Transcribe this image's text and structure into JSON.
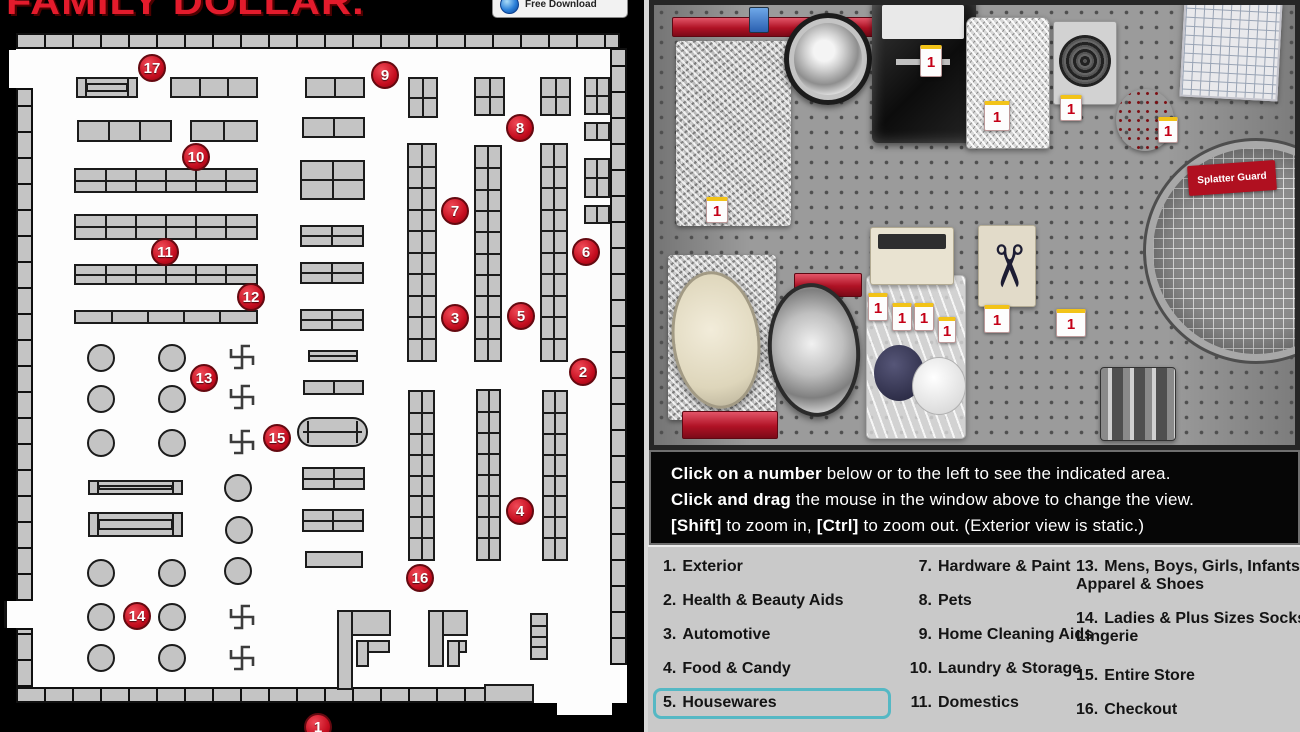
{
  "colors": {
    "marker_red": "#c50d1f",
    "highlight_teal": "#55b8c4",
    "legend_bg": "#c9c9c9",
    "logo_red": "#e31b2c"
  },
  "branding": {
    "logo": "FAMILY DOLLAR.",
    "badge": "Free Download"
  },
  "instructions": {
    "lines": [
      [
        {
          "text": "Click on a number",
          "bold": true
        },
        {
          "text": " below or to the left to see the indicated area.",
          "bold": false
        }
      ],
      [
        {
          "text": "Click and drag",
          "bold": true
        },
        {
          "text": " the mouse in the window above to change the view.",
          "bold": false
        }
      ],
      [
        {
          "text": "[Shift]",
          "bold": true
        },
        {
          "text": " to zoom in, ",
          "bold": false
        },
        {
          "text": "[Ctrl]",
          "bold": true
        },
        {
          "text": " to zoom out. (Exterior view is static.)",
          "bold": false
        }
      ]
    ]
  },
  "legend": {
    "selected_number": "5",
    "columns": [
      {
        "x": 15,
        "width": 215,
        "cls": "col1",
        "items": [
          {
            "num": "1.",
            "label": "Exterior",
            "y": 11
          },
          {
            "num": "2.",
            "label": "Health & Beauty Aids",
            "y": 45
          },
          {
            "num": "3.",
            "label": "Automotive",
            "y": 79
          },
          {
            "num": "4.",
            "label": "Food & Candy",
            "y": 113
          },
          {
            "num": "5.",
            "label": "Housewares",
            "y": 147,
            "selected": true
          }
        ]
      },
      {
        "x": 258,
        "width": 215,
        "cls": "col2",
        "items": [
          {
            "num": "7.",
            "label": "Hardware & Paint",
            "y": 11
          },
          {
            "num": "8.",
            "label": "Pets",
            "y": 45
          },
          {
            "num": "9.",
            "label": "Home Cleaning Aids",
            "y": 79
          },
          {
            "num": "10.",
            "label": "Laundry & Storage",
            "y": 113
          },
          {
            "num": "11.",
            "label": "Domestics",
            "y": 147
          }
        ]
      },
      {
        "x": 428,
        "width": 235,
        "cls": "col3",
        "items": [
          {
            "num": "13.",
            "label": "Mens, Boys, Girls, Infants Apparel & Shoes",
            "y": 11
          },
          {
            "num": "14.",
            "label": "Ladies & Plus Sizes Socks, Lingerie",
            "y": 63
          },
          {
            "num": "15.",
            "label": "Entire Store",
            "y": 120
          },
          {
            "num": "16.",
            "label": "Checkout",
            "y": 154
          }
        ]
      }
    ]
  },
  "map": {
    "floor": {
      "x": 16,
      "y": 48,
      "w": 611,
      "h": 655
    },
    "walls": [
      {
        "x": 16,
        "y": 33,
        "w": 604,
        "h": 16,
        "d": "h"
      },
      {
        "x": 16,
        "y": 687,
        "w": 472,
        "h": 16,
        "d": "h"
      },
      {
        "x": 16,
        "y": 88,
        "w": 17,
        "h": 513,
        "d": "v"
      },
      {
        "x": 16,
        "y": 628,
        "w": 17,
        "h": 59,
        "d": "v"
      },
      {
        "x": 610,
        "y": 48,
        "w": 17,
        "h": 617,
        "d": "v"
      }
    ],
    "notches": [
      {
        "x": 9,
        "y": 50,
        "w": 24,
        "h": 38,
        "edge": false
      },
      {
        "x": 4,
        "y": 601,
        "w": 14,
        "h": 27,
        "edge": true
      },
      {
        "x": 557,
        "y": 700,
        "w": 55,
        "h": 15,
        "edge": false
      }
    ],
    "shelves": [
      {
        "x": 76,
        "y": 77,
        "w": 62,
        "h": 21,
        "t": "rack"
      },
      {
        "x": 170,
        "y": 77,
        "w": 88,
        "h": 21,
        "c": 3
      },
      {
        "x": 305,
        "y": 77,
        "w": 60,
        "h": 21,
        "c": 2
      },
      {
        "x": 408,
        "y": 77,
        "w": 30,
        "h": 41,
        "c": 2,
        "r": 2
      },
      {
        "x": 474,
        "y": 77,
        "w": 31,
        "h": 39,
        "c": 2,
        "r": 2
      },
      {
        "x": 540,
        "y": 77,
        "w": 31,
        "h": 39,
        "c": 2,
        "r": 2
      },
      {
        "x": 584,
        "y": 77,
        "w": 26,
        "h": 38,
        "c": 2,
        "r": 2
      },
      {
        "x": 584,
        "y": 122,
        "w": 26,
        "h": 19,
        "c": 2
      },
      {
        "x": 584,
        "y": 158,
        "w": 26,
        "h": 40,
        "c": 2,
        "r": 2
      },
      {
        "x": 584,
        "y": 205,
        "w": 26,
        "h": 19,
        "c": 2
      },
      {
        "x": 77,
        "y": 120,
        "w": 95,
        "h": 22,
        "c": 3
      },
      {
        "x": 190,
        "y": 120,
        "w": 68,
        "h": 22,
        "c": 2
      },
      {
        "x": 302,
        "y": 117,
        "w": 63,
        "h": 21,
        "c": 2
      },
      {
        "x": 74,
        "y": 168,
        "w": 184,
        "h": 25,
        "c": 6,
        "r": 2
      },
      {
        "x": 74,
        "y": 214,
        "w": 184,
        "h": 26,
        "c": 6,
        "r": 2
      },
      {
        "x": 74,
        "y": 264,
        "w": 184,
        "h": 21,
        "c": 6,
        "r": 2
      },
      {
        "x": 74,
        "y": 310,
        "w": 184,
        "h": 14,
        "c": 5
      },
      {
        "x": 300,
        "y": 160,
        "w": 65,
        "h": 40,
        "c": 2,
        "r": 2
      },
      {
        "x": 300,
        "y": 225,
        "w": 64,
        "h": 22,
        "c": 2,
        "r": 2
      },
      {
        "x": 300,
        "y": 262,
        "w": 64,
        "h": 22,
        "c": 2,
        "r": 2
      },
      {
        "x": 300,
        "y": 309,
        "w": 64,
        "h": 22,
        "c": 2,
        "r": 2
      },
      {
        "x": 308,
        "y": 350,
        "w": 50,
        "h": 12,
        "r": 2
      },
      {
        "x": 303,
        "y": 380,
        "w": 61,
        "h": 15,
        "c": 2
      },
      {
        "x": 297,
        "y": 417,
        "w": 71,
        "h": 30,
        "t": "capsule"
      },
      {
        "x": 302,
        "y": 467,
        "w": 63,
        "h": 23,
        "c": 2,
        "r": 2
      },
      {
        "x": 302,
        "y": 509,
        "w": 62,
        "h": 23,
        "c": 2,
        "r": 2
      },
      {
        "x": 305,
        "y": 551,
        "w": 58,
        "h": 17
      },
      {
        "x": 407,
        "y": 143,
        "w": 30,
        "h": 219,
        "c": 2,
        "r": 10
      },
      {
        "x": 474,
        "y": 145,
        "w": 28,
        "h": 217,
        "c": 2,
        "r": 10
      },
      {
        "x": 540,
        "y": 143,
        "w": 28,
        "h": 219,
        "c": 2,
        "r": 10
      },
      {
        "x": 408,
        "y": 390,
        "w": 27,
        "h": 171,
        "c": 2,
        "r": 8
      },
      {
        "x": 476,
        "y": 389,
        "w": 25,
        "h": 172,
        "c": 2,
        "r": 8
      },
      {
        "x": 542,
        "y": 390,
        "w": 26,
        "h": 171,
        "c": 2,
        "r": 8
      },
      {
        "x": 88,
        "y": 480,
        "w": 95,
        "h": 15,
        "t": "rack"
      },
      {
        "x": 88,
        "y": 512,
        "w": 95,
        "h": 25,
        "t": "rack"
      },
      {
        "x": 337,
        "y": 610,
        "w": 54,
        "h": 26
      },
      {
        "x": 337,
        "y": 610,
        "w": 16,
        "h": 80
      },
      {
        "x": 356,
        "y": 640,
        "w": 34,
        "h": 13
      },
      {
        "x": 356,
        "y": 640,
        "w": 13,
        "h": 27
      },
      {
        "x": 428,
        "y": 610,
        "w": 40,
        "h": 26
      },
      {
        "x": 428,
        "y": 610,
        "w": 16,
        "h": 57
      },
      {
        "x": 447,
        "y": 640,
        "w": 20,
        "h": 13
      },
      {
        "x": 447,
        "y": 640,
        "w": 13,
        "h": 27
      },
      {
        "x": 530,
        "y": 613,
        "w": 18,
        "h": 47,
        "r": 4
      },
      {
        "x": 484,
        "y": 684,
        "w": 50,
        "h": 19
      }
    ],
    "circle_racks": [
      [
        101,
        358
      ],
      [
        172,
        358
      ],
      [
        101,
        399
      ],
      [
        172,
        399
      ],
      [
        101,
        443
      ],
      [
        172,
        443
      ],
      [
        101,
        573
      ],
      [
        172,
        573
      ],
      [
        101,
        617
      ],
      [
        172,
        617
      ],
      [
        101,
        658
      ],
      [
        172,
        658
      ],
      [
        238,
        488
      ],
      [
        239,
        530
      ],
      [
        238,
        571
      ]
    ],
    "pinwheel_racks": [
      [
        242,
        357
      ],
      [
        242,
        397
      ],
      [
        242,
        442
      ],
      [
        242,
        617
      ],
      [
        242,
        658
      ]
    ],
    "markers": [
      {
        "n": "1",
        "x": 318,
        "y": 727
      },
      {
        "n": "2",
        "x": 583,
        "y": 372
      },
      {
        "n": "3",
        "x": 455,
        "y": 318
      },
      {
        "n": "4",
        "x": 520,
        "y": 511
      },
      {
        "n": "5",
        "x": 521,
        "y": 316
      },
      {
        "n": "6",
        "x": 586,
        "y": 252
      },
      {
        "n": "7",
        "x": 455,
        "y": 211
      },
      {
        "n": "8",
        "x": 520,
        "y": 128
      },
      {
        "n": "9",
        "x": 385,
        "y": 75
      },
      {
        "n": "10",
        "x": 196,
        "y": 157
      },
      {
        "n": "11",
        "x": 165,
        "y": 252
      },
      {
        "n": "12",
        "x": 251,
        "y": 297
      },
      {
        "n": "13",
        "x": 204,
        "y": 378
      },
      {
        "n": "14",
        "x": 137,
        "y": 616
      },
      {
        "n": "15",
        "x": 277,
        "y": 438
      },
      {
        "n": "16",
        "x": 420,
        "y": 578
      },
      {
        "n": "17",
        "x": 152,
        "y": 68
      }
    ]
  },
  "photo": {
    "price_tag": "1",
    "splatter_label": "Splatter Guard",
    "scissors_glyph": "✂",
    "products": [
      {
        "kind": "rail",
        "name": "red-shelf-rail",
        "x": 18,
        "y": 12,
        "w": 250,
        "h": 20
      },
      {
        "kind": "tagblue",
        "name": "hanging-tag-blue",
        "x": 95,
        "y": 2,
        "w": 20,
        "h": 26
      },
      {
        "kind": "foil",
        "name": "foil-pans-stack",
        "x": 22,
        "y": 36,
        "w": 115,
        "h": 185
      },
      {
        "kind": "tag",
        "name": "price-tag",
        "x": 52,
        "y": 192,
        "w": 22,
        "h": 26
      },
      {
        "kind": "tag",
        "name": "price-tag",
        "x": 142,
        "y": 24,
        "w": 24,
        "h": 32
      },
      {
        "kind": "pan",
        "name": "round-foil-pan",
        "x": 130,
        "y": 8,
        "w": 88,
        "h": 92
      },
      {
        "kind": "packdark",
        "name": "scour-pad-pack",
        "x": 218,
        "y": -8,
        "w": 104,
        "h": 146
      },
      {
        "kind": "tag",
        "name": "price-tag",
        "x": 266,
        "y": 40,
        "w": 22,
        "h": 32
      },
      {
        "kind": "bagsteel",
        "name": "steel-wool-bag",
        "x": 312,
        "y": 12,
        "w": 84,
        "h": 132
      },
      {
        "kind": "tag",
        "name": "price-tag",
        "x": 330,
        "y": 96,
        "w": 26,
        "h": 30
      },
      {
        "kind": "scourer",
        "name": "metal-scourer-pack",
        "x": 399,
        "y": 16,
        "w": 64,
        "h": 84
      },
      {
        "kind": "tag",
        "name": "price-tag",
        "x": 406,
        "y": 90,
        "w": 22,
        "h": 26
      },
      {
        "kind": "reddisc",
        "name": "red-strainer",
        "x": 462,
        "y": 84,
        "w": 58,
        "h": 62
      },
      {
        "kind": "tag",
        "name": "price-tag",
        "x": 504,
        "y": 112,
        "w": 20,
        "h": 26
      },
      {
        "kind": "gridpack",
        "name": "splatter-screen-pack",
        "x": 528,
        "y": -6,
        "w": 98,
        "h": 100
      },
      {
        "kind": "splatter",
        "name": "splatter-guard",
        "x": 492,
        "y": 136,
        "w": 220,
        "h": 220
      },
      {
        "kind": "splatterlabel",
        "name": "splatter-guard-label",
        "x": 534,
        "y": 158,
        "w": 88,
        "h": 30
      },
      {
        "kind": "foil",
        "name": "foil-pack",
        "x": 14,
        "y": 250,
        "w": 108,
        "h": 165
      },
      {
        "kind": "pancream",
        "name": "cream-cake-pan",
        "x": 18,
        "y": 266,
        "w": 88,
        "h": 138
      },
      {
        "kind": "rail",
        "name": "red-shelf-rail",
        "x": 140,
        "y": 268,
        "w": 68,
        "h": 24
      },
      {
        "kind": "panellipse",
        "name": "oval-foil-pan",
        "x": 114,
        "y": 278,
        "w": 92,
        "h": 134
      },
      {
        "kind": "bag",
        "name": "bowl-covers-bag",
        "x": 212,
        "y": 270,
        "w": 100,
        "h": 164
      },
      {
        "kind": "circlenavy",
        "name": "navy-bowl-cover",
        "x": 220,
        "y": 340,
        "w": 50,
        "h": 56
      },
      {
        "kind": "circlewhite",
        "name": "white-bowl-cover",
        "x": 258,
        "y": 352,
        "w": 54,
        "h": 58
      },
      {
        "kind": "tag",
        "name": "price-tag",
        "x": 214,
        "y": 288,
        "w": 20,
        "h": 28
      },
      {
        "kind": "tag",
        "name": "price-tag",
        "x": 238,
        "y": 298,
        "w": 20,
        "h": 28
      },
      {
        "kind": "tag",
        "name": "price-tag",
        "x": 260,
        "y": 298,
        "w": 20,
        "h": 28
      },
      {
        "kind": "tag",
        "name": "price-tag",
        "x": 284,
        "y": 312,
        "w": 18,
        "h": 26
      },
      {
        "kind": "packcream",
        "name": "scrub-pads-box",
        "x": 216,
        "y": 222,
        "w": 84,
        "h": 58
      },
      {
        "kind": "scissors",
        "name": "scissors-card",
        "x": 324,
        "y": 220,
        "w": 58,
        "h": 82
      },
      {
        "kind": "tag",
        "name": "price-tag",
        "x": 330,
        "y": 300,
        "w": 26,
        "h": 28
      },
      {
        "kind": "tag",
        "name": "price-tag",
        "x": 402,
        "y": 304,
        "w": 30,
        "h": 28
      },
      {
        "kind": "rolls",
        "name": "foil-rolls",
        "x": 446,
        "y": 362,
        "w": 76,
        "h": 74
      },
      {
        "kind": "rail",
        "name": "red-items",
        "x": 28,
        "y": 406,
        "w": 96,
        "h": 28
      }
    ]
  }
}
